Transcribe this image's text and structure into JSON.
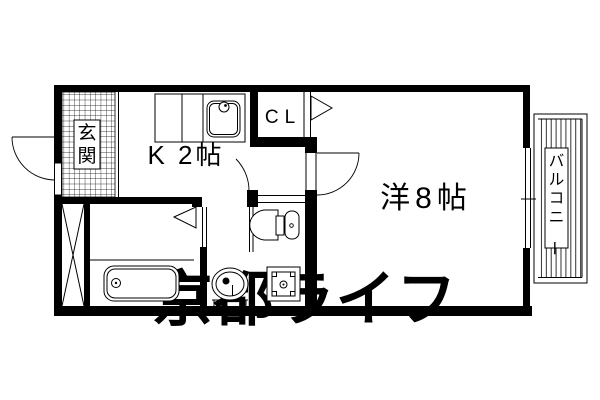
{
  "floorplan": {
    "rooms": {
      "entrance_label": "玄関",
      "kitchen_label": "K 2帖",
      "closet_label": "CL",
      "western_room_label": "洋8帖",
      "balcony_label": "バルコニー"
    },
    "watermark_text": "京都ライフ",
    "colors": {
      "line": "#000000",
      "background": "#ffffff",
      "watermark": "#e7e7e7"
    }
  }
}
